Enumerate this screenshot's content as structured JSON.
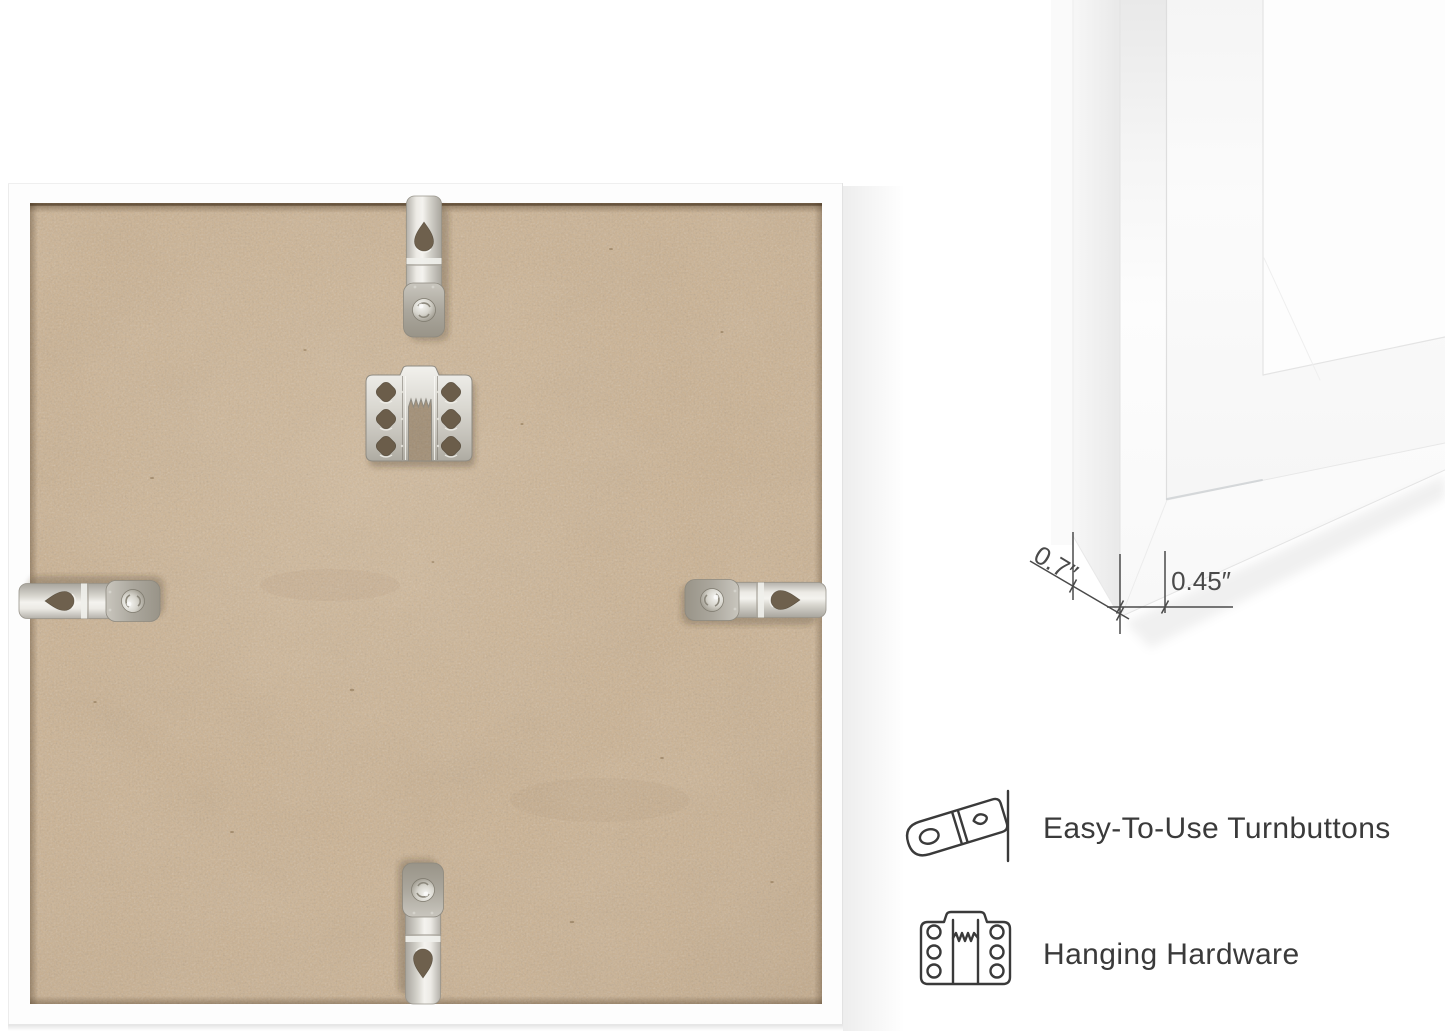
{
  "scene": {
    "view": "picture frame product image",
    "main_view": "frame-back with mounting hardware",
    "turnbutton_count": 4,
    "sawtooth_hanger_count": 1
  },
  "dimensions": {
    "depth_label": "0.7″",
    "face_width_label": "0.45″",
    "depth_inches": 0.7,
    "face_width_inches": 0.45
  },
  "features": [
    {
      "id": "turnbuttons",
      "icon": "turnbutton-icon",
      "label": "Easy-To-Use Turnbuttons"
    },
    {
      "id": "hanging-hardware",
      "icon": "sawtooth-hanger-icon",
      "label": "Hanging Hardware"
    }
  ],
  "icons": {
    "turnbutton_icon": "outline drawing of a rotating metal turnbutton tab beside a frame edge line",
    "sawtooth_hanger_icon": "outline drawing of a sawtooth hanging bracket with six screw holes"
  },
  "colors": {
    "background": "#ffffff",
    "mdf_board": "#ccb291",
    "frame_white": "#fdfdfd",
    "metal_highlight": "#f1f0ec",
    "metal_shadow": "#9a968c",
    "line_art": "#3a3a3a",
    "dimension_lines": "#4a4a4a",
    "text": "#3a3a3a"
  }
}
